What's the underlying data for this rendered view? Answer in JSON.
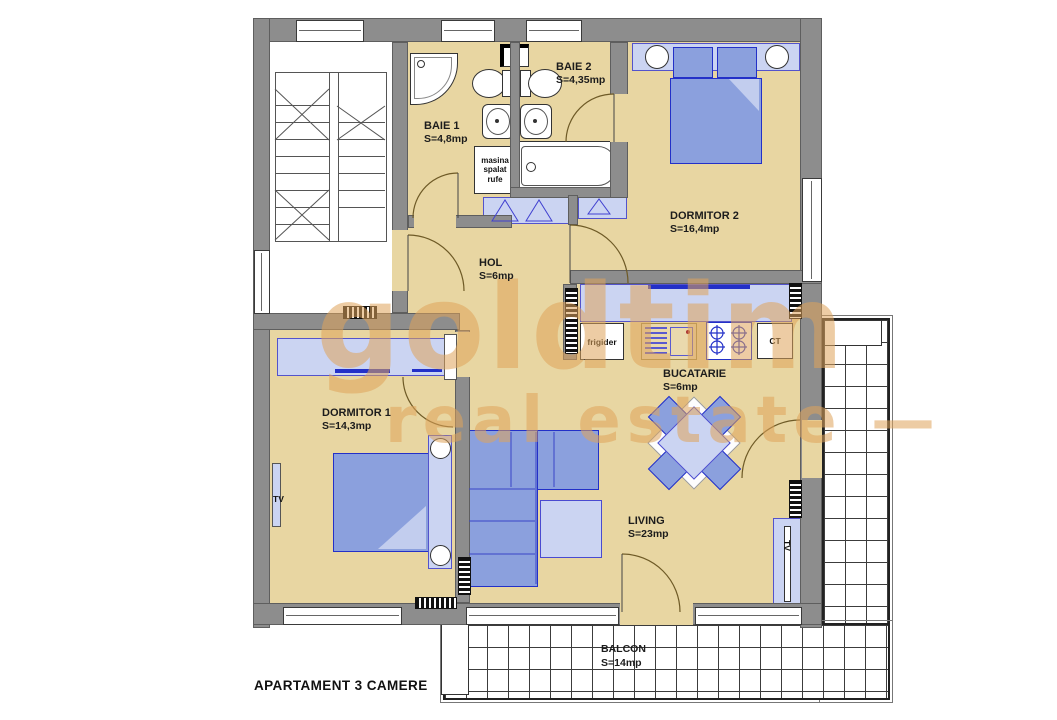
{
  "title": "APARTAMENT 3 CAMERE",
  "watermark": {
    "line1": "goldtim",
    "line2": "real estate —"
  },
  "rooms": {
    "baie1": {
      "name": "BAIE 1",
      "area": "S=4,8mp"
    },
    "baie2": {
      "name": "BAIE 2",
      "area": "S=4,35mp"
    },
    "dormitor2": {
      "name": "DORMITOR 2",
      "area": "S=16,4mp"
    },
    "hol": {
      "name": "HOL",
      "area": "S=6mp"
    },
    "dormitor1": {
      "name": "DORMITOR 1",
      "area": "S=14,3mp"
    },
    "bucatarie": {
      "name": "BUCATARIE",
      "area": "S=6mp"
    },
    "living": {
      "name": "LIVING",
      "area": "S=23mp"
    },
    "balcon": {
      "name": "BALCON",
      "area": "S=14mp"
    }
  },
  "labels": {
    "washing_machine": "masina spalat rufe",
    "fridge": "frigider",
    "boiler": "CT",
    "tv": "TV"
  },
  "colors": {
    "floor": "#e8d6a2",
    "wall": "#8d8d8d",
    "furniture_light": "#cbd4f2",
    "furniture_blue": "#8ba0dd",
    "accent_blue": "#2330c8",
    "watermark": "#dfa45b"
  }
}
